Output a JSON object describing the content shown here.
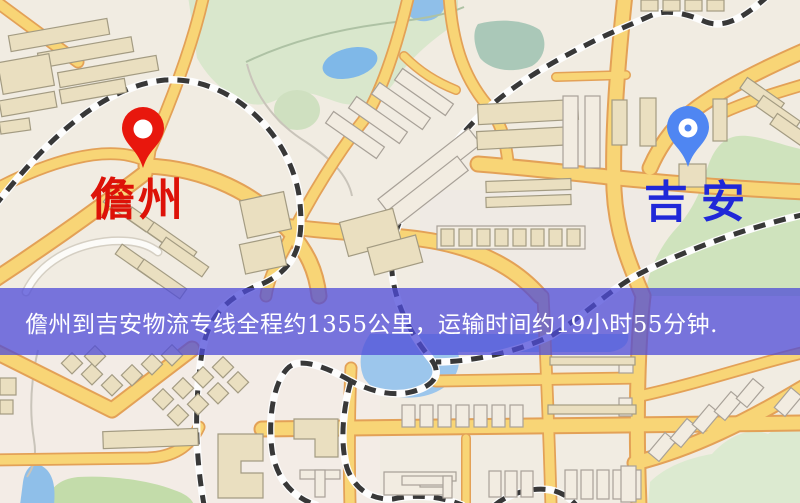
{
  "map": {
    "origin": {
      "label": "儋州",
      "pin_color": "#e8170d",
      "label_color": "#dd1208"
    },
    "destination": {
      "label": "吉安",
      "pin_color": "#4f86f2",
      "label_color": "#2028d8"
    }
  },
  "banner": {
    "text": "儋州到吉安物流专线全程约1355公里，运输时间约19小时55分钟.",
    "overlay_color": "#4d4bd8",
    "text_color": "#ffffff",
    "distance": "约1355公里",
    "duration": "约19小时55分钟"
  },
  "palette": {
    "background": "#f1ece2",
    "road_yellow": "#f8d576",
    "road_casing": "#e3a157",
    "park_green": "#d9e7cc",
    "water_blue": "#9cc6ec",
    "railway": "#383838"
  }
}
